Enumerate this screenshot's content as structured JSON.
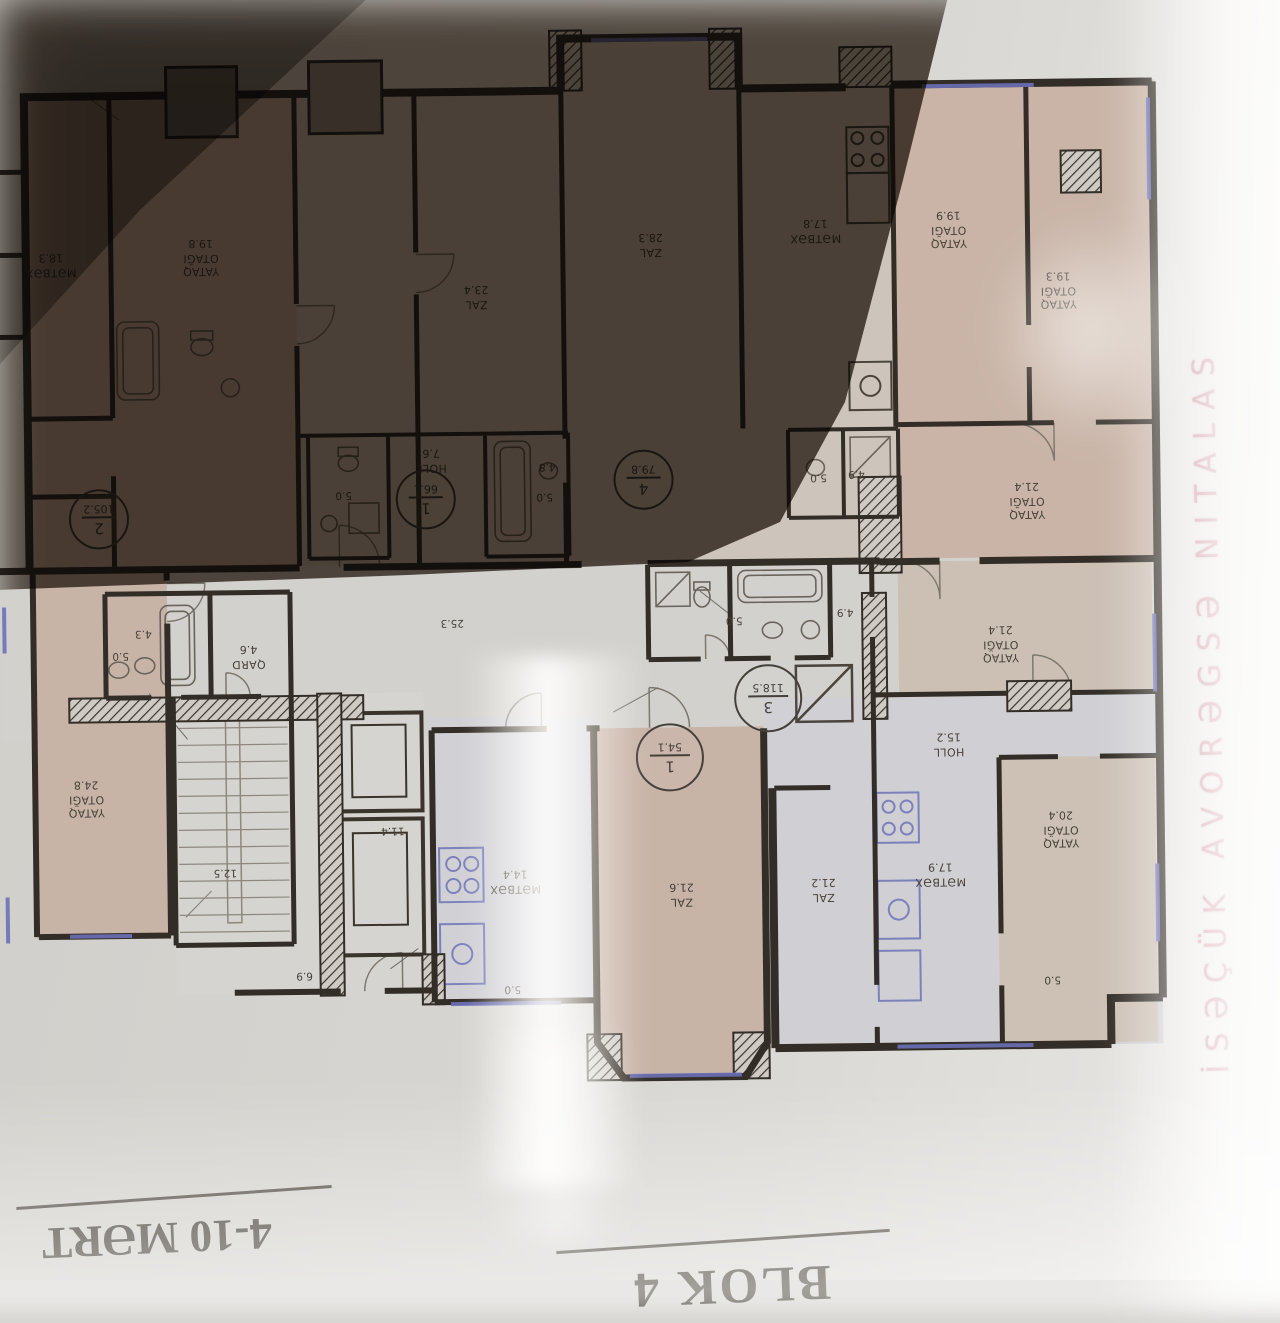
{
  "page": {
    "street_label": "SALATIN ƏSGƏROVA KÜÇƏSİ",
    "footer": {
      "floors_label": "4-10 MƏRT",
      "block_label": "BLOK 4"
    },
    "colors": {
      "paper": "#D6D4D0",
      "wall_ink": "#332D27",
      "window_accent": "#6B70B8",
      "fixture_accent": "#7D81BB",
      "street_text_pink": "#BD6D7E",
      "room_pink_fill": "#C8B3A7",
      "room_gray_fill": "#D0D0D5",
      "shadow_brown": "#382D22"
    }
  },
  "apartments": [
    {
      "number": "1",
      "area": "66.1"
    },
    {
      "number": "4",
      "area": "79.8"
    },
    {
      "number": "2",
      "area": "105.2"
    },
    {
      "number": "3",
      "area": "118.5"
    },
    {
      "number": "1",
      "area": "54.1"
    }
  ],
  "rooms": [
    {
      "label": "MƏTBƏX",
      "area": "18.3"
    },
    {
      "label": "YATAQ OTAĞI",
      "area": "19.8"
    },
    {
      "label": "ZAL",
      "area": "23.4"
    },
    {
      "label": "ZAL",
      "area": "28.3"
    },
    {
      "label": "MƏTBƏX",
      "area": "17.8"
    },
    {
      "label": "YATAQ OTAĞI",
      "area": "19.9"
    },
    {
      "label": "YATAQ OTAĞI",
      "area": "19.3"
    },
    {
      "label": "HOLL",
      "area": "7.6"
    },
    {
      "label": "YATAQ OTAĞI",
      "area": "21.4"
    },
    {
      "label": "QARD",
      "area": "4.6"
    },
    {
      "label": "YATAQ OTAĞI",
      "area": "21.4"
    },
    {
      "label": "HOLL",
      "area": "15.2"
    },
    {
      "label": "YATAQ OTAĞI",
      "area": "24.8"
    },
    {
      "label": "MƏTBƏX",
      "area": "14.4"
    },
    {
      "label": "ZAL",
      "area": "21.6"
    },
    {
      "label": "ZAL",
      "area": "21.2"
    },
    {
      "label": "MƏTBƏX",
      "area": "17.9"
    },
    {
      "label": "YATAQ OTAĞI",
      "area": "20.4"
    }
  ],
  "small_labels": [
    {
      "t": "5.0"
    },
    {
      "t": "4.8"
    },
    {
      "t": "5.0"
    },
    {
      "t": "5.0"
    },
    {
      "t": "4.9"
    },
    {
      "t": "5.0"
    },
    {
      "t": "4.9"
    },
    {
      "t": "4.3"
    },
    {
      "t": "5.0"
    },
    {
      "t": "12.5"
    },
    {
      "t": "11.4"
    },
    {
      "t": "6.9"
    },
    {
      "t": "5.0"
    },
    {
      "t": "5.0"
    },
    {
      "t": "25.3"
    }
  ]
}
